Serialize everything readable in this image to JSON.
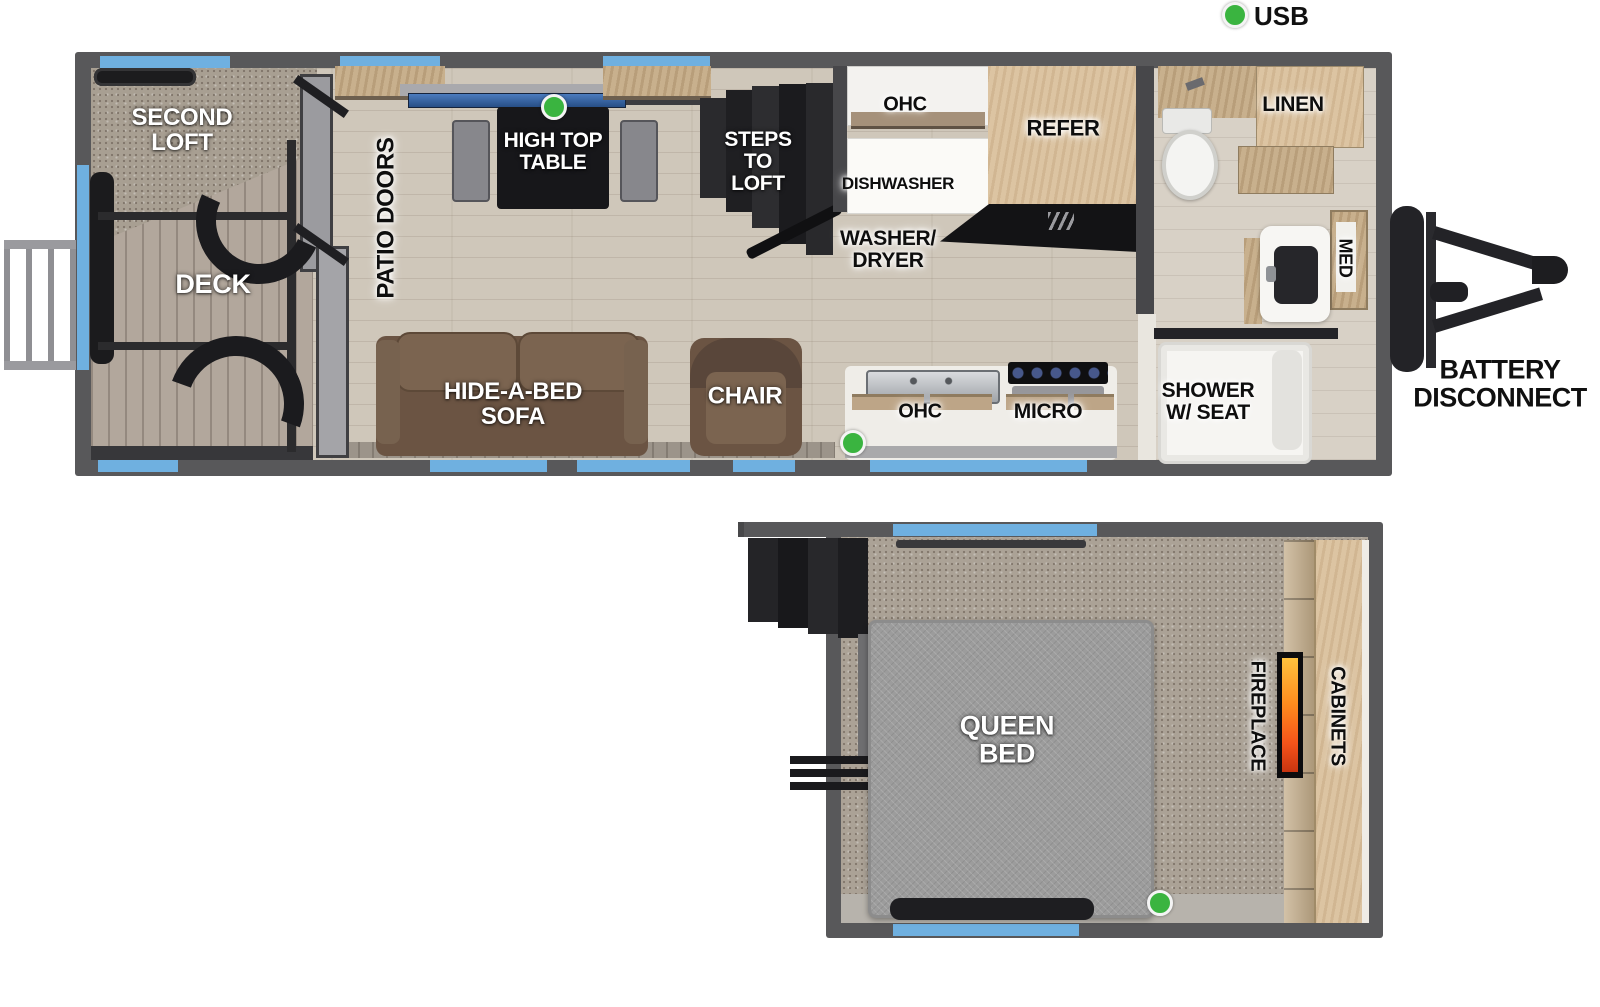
{
  "legend": {
    "usb": "USB"
  },
  "main_floor": {
    "second_loft": "SECOND\nLOFT",
    "deck": "DECK",
    "patio_doors": "PATIO DOORS",
    "high_top_table": "HIGH TOP\nTABLE",
    "steps_to_loft": "STEPS\nTO\nLOFT",
    "ohc_top": "OHC",
    "dishwasher": "DISHWASHER",
    "washer_dryer": "WASHER/\nDRYER",
    "refer": "REFER",
    "linen": "LINEN",
    "med": "MED",
    "ohc_bottom": "OHC",
    "micro": "MICRO",
    "shower": "SHOWER\nW/ SEAT",
    "sofa": "HIDE-A-BED\nSOFA",
    "chair": "CHAIR",
    "battery_disconnect": "BATTERY\nDISCONNECT"
  },
  "loft_floor": {
    "queen_bed": "QUEEN\nBED",
    "fireplace": "FIREPLACE",
    "cabinets": "CABINETS"
  },
  "colors": {
    "wall_gray": "#58585a",
    "window_blue": "#6fb0e0",
    "usb_green": "#3ab440",
    "flame_orange": "#ff8c1e",
    "wood_floor": "#cfc7ba",
    "deck_wood": "#b2a79c",
    "carpet": "#a89f92",
    "cabinet_wood": "#dcc4a2",
    "sofa_brown": "#6b5443",
    "bed_gray": "#9c9c9c",
    "table_black": "#17171a"
  }
}
